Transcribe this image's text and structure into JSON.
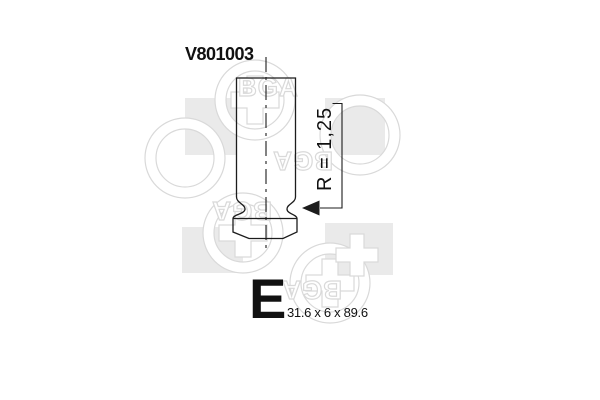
{
  "product": {
    "part_number": "V801003",
    "valve_type_letter": "E",
    "dimensions_label": "31.6 x 6 x 89.6",
    "radius_label": "R = 1,25"
  },
  "watermark": {
    "brand": "BGA"
  },
  "colors": {
    "line": "#1c1c1c",
    "text": "#111111",
    "watermark_fill": "#eaeaea",
    "watermark_outline": "#d9d9d9"
  }
}
